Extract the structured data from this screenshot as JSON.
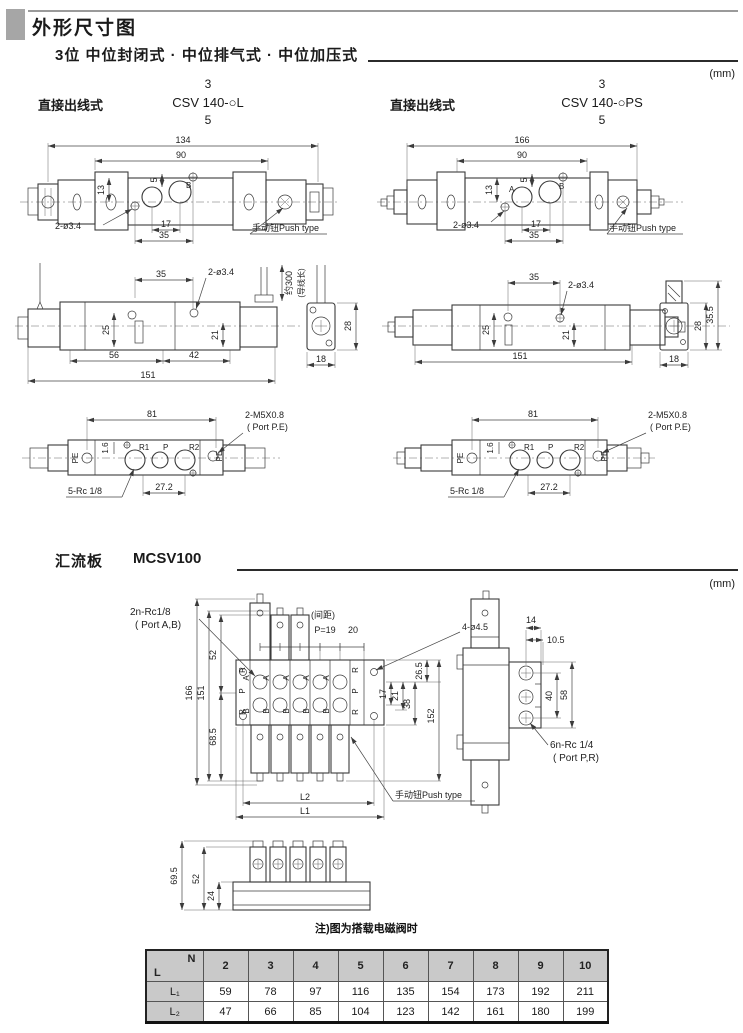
{
  "header": {
    "title": "外形尺寸图",
    "section_title": "3位 中位封闭式 · 中位排气式 · 中位加压式",
    "unit": "(mm)",
    "left": {
      "wiring": "直接出线式",
      "pos_top": "3",
      "model": "CSV 140-○L",
      "pos_bottom": "5"
    },
    "right": {
      "wiring": "直接出线式",
      "pos_top": "3",
      "model": "CSV 140-○PS",
      "pos_bottom": "5"
    }
  },
  "tv": {
    "d134": "134",
    "d166": "166",
    "d90": "90",
    "d13": "13",
    "d5": "5",
    "d17": "17",
    "d35": "35",
    "hole": "2-ø3.4",
    "push": "手动钮Push type",
    "pa": "A",
    "pb": "B"
  },
  "sv": {
    "d35": "35",
    "hole": "2-ø3.4",
    "lead": "约300",
    "leadnote": "(导线长)",
    "d25": "25",
    "d21": "21",
    "d56": "56",
    "d42": "42",
    "d151": "151",
    "d28": "28",
    "d18": "18",
    "d355": "35.5"
  },
  "bv": {
    "d81": "81",
    "thread": "2-M5X0.8",
    "threadport": "( Port P.E)",
    "d16": "1.6",
    "pe": "PE",
    "r1": "R1",
    "p": "P",
    "r2": "R2",
    "rc": "5-Rc 1/8",
    "d272": "27.2"
  },
  "m": {
    "title": "汇流板",
    "model": "MCSV100",
    "unit": "(mm)",
    "note": "注)图为搭载电磁阀时"
  },
  "mf": {
    "rc": "2n-Rc1/8",
    "rcport": "( Port A,B)",
    "pitchnote": "(间距)",
    "pitch": "P=19",
    "d20": "20",
    "holes": "4-ø4.5",
    "d166": "166",
    "d151": "151",
    "d52": "52",
    "d685": "68.5",
    "d17": "17",
    "d21": "21",
    "d38": "38",
    "d265": "26.5",
    "d152": "152",
    "l1": "L1",
    "l2": "L2",
    "push": "手动钮Push type",
    "pa": "A",
    "pb": "B",
    "pp": "P",
    "pr": "R"
  },
  "ms": {
    "d14": "14",
    "d105": "10.5",
    "d40": "40",
    "d58": "58",
    "rc": "6n-Rc 1/4",
    "rcport": "( Port P,R)"
  },
  "mb": {
    "d695": "69.5",
    "d52": "52",
    "d24": "24"
  },
  "table": {
    "corner_n": "N",
    "corner_l": "L",
    "cols": [
      "2",
      "3",
      "4",
      "5",
      "6",
      "7",
      "8",
      "9",
      "10"
    ],
    "rows": [
      {
        "label": "L₁",
        "values": [
          "59",
          "78",
          "97",
          "116",
          "135",
          "154",
          "173",
          "192",
          "211"
        ]
      },
      {
        "label": "L₂",
        "values": [
          "47",
          "66",
          "85",
          "104",
          "123",
          "142",
          "161",
          "180",
          "199"
        ]
      }
    ]
  }
}
